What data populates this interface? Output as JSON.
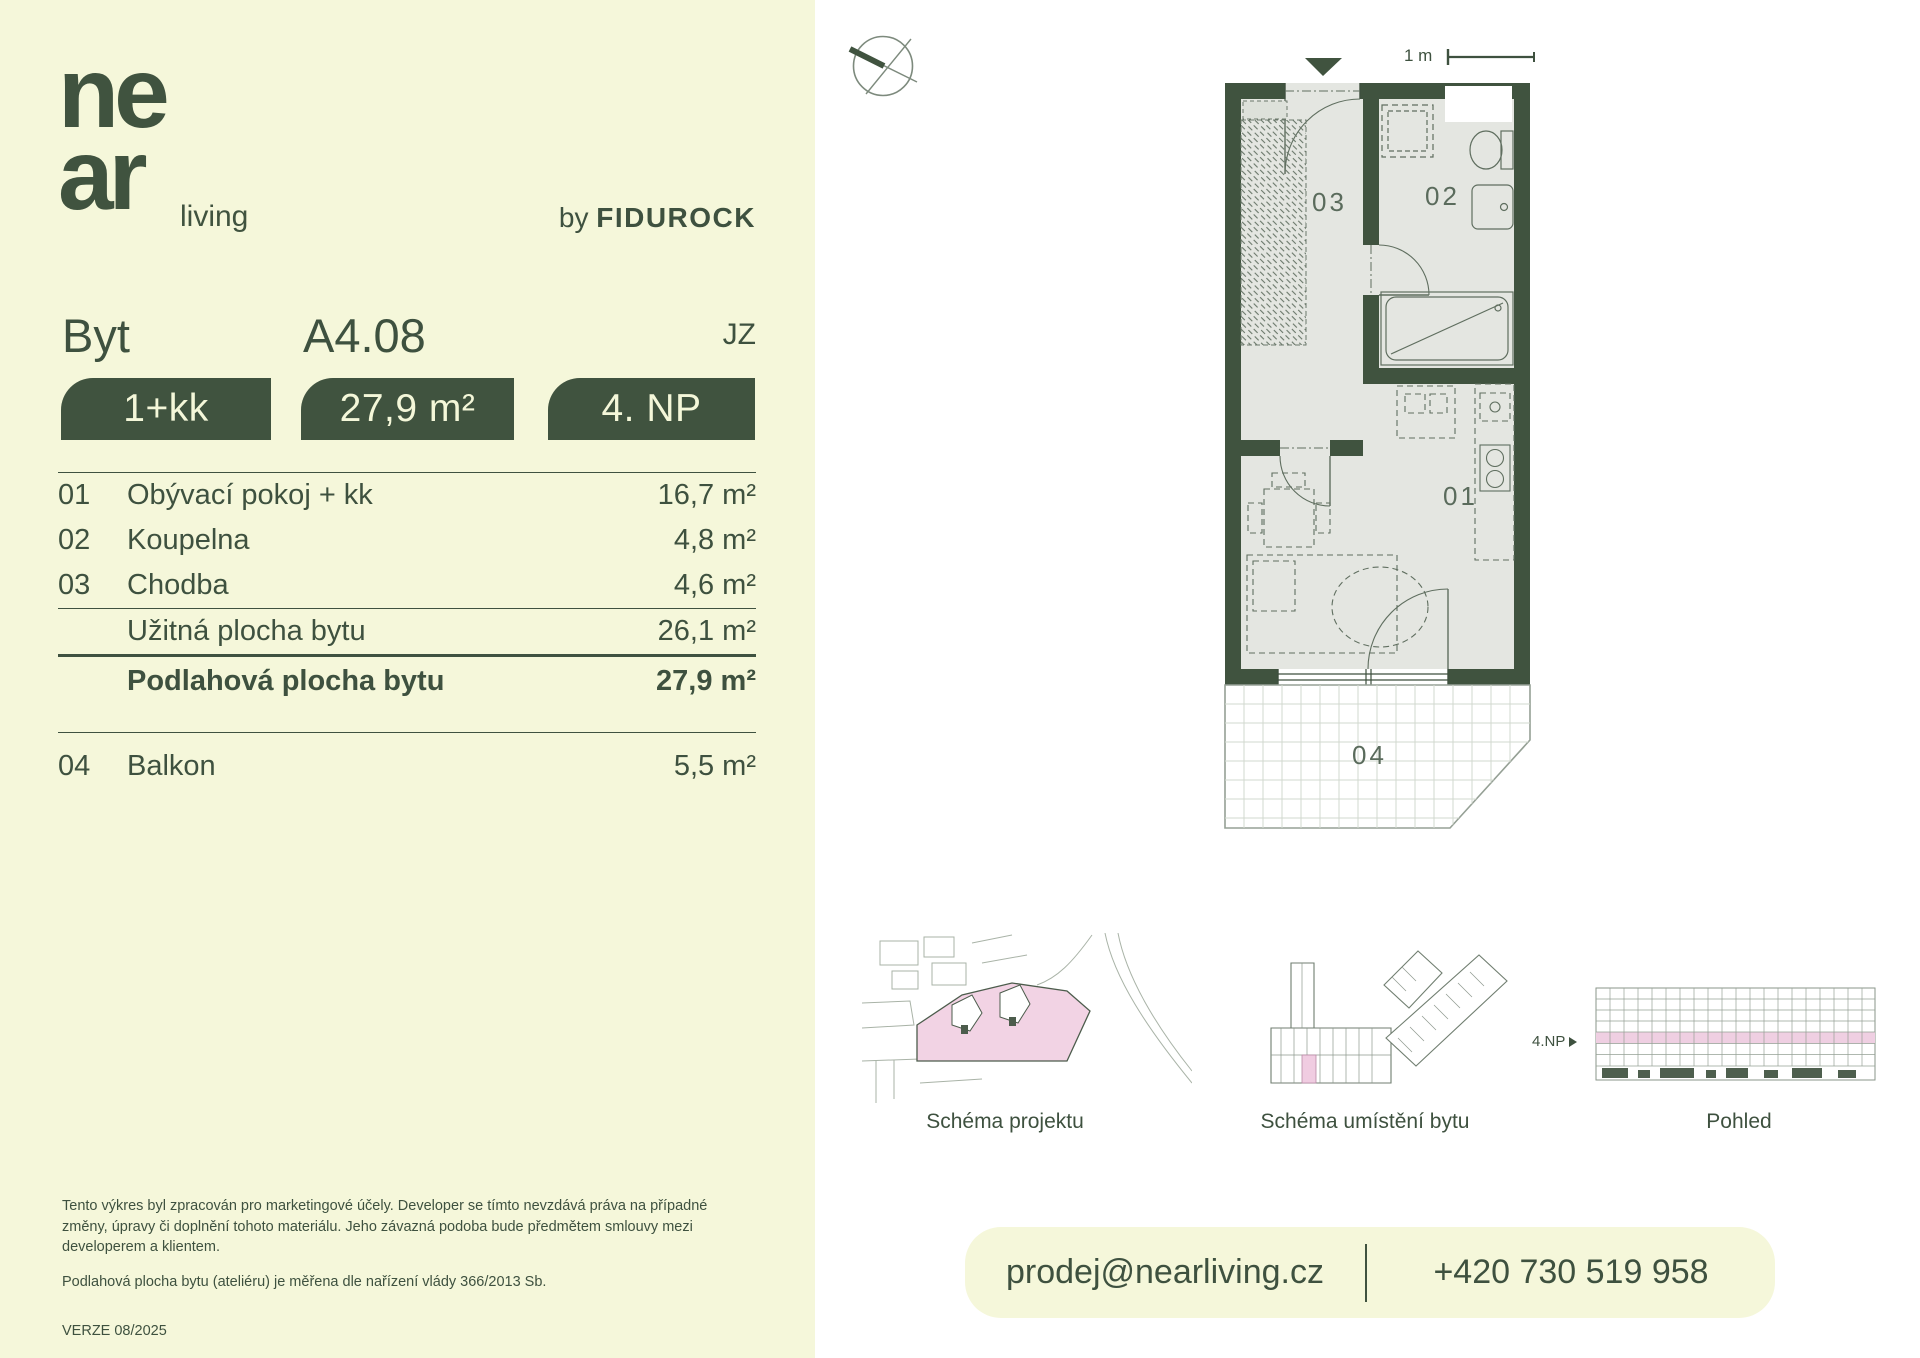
{
  "brand": {
    "logo_line1": "ne",
    "logo_line2": "ar",
    "logo_suffix": "living",
    "byline_prefix": "by",
    "byline_brand": "FIDUROCK"
  },
  "header": {
    "unit_label": "Byt",
    "unit_number": "A4.08",
    "orientation": "JZ"
  },
  "badges": [
    {
      "label": "1+kk"
    },
    {
      "label": "27,9 m²"
    },
    {
      "label": "4. NP"
    }
  ],
  "rooms": [
    {
      "num": "01",
      "name": "Obývací pokoj + kk",
      "area": "16,7 m²"
    },
    {
      "num": "02",
      "name": "Koupelna",
      "area": "4,8 m²"
    },
    {
      "num": "03",
      "name": "Chodba",
      "area": "4,6 m²"
    }
  ],
  "totals": {
    "usable_label": "Užitná plocha bytu",
    "usable_area": "26,1 m²",
    "floor_label": "Podlahová plocha bytu",
    "floor_area": "27,9 m²"
  },
  "extras": [
    {
      "num": "04",
      "name": "Balkon",
      "area": "5,5 m²"
    }
  ],
  "disclaimer": {
    "paragraph": "Tento výkres byl zpracován pro marketingové účely. Developer se tímto nevzdává práva na případné změny, úpravy či doplnění tohoto materiálu. Jeho závazná podoba bude předmětem smlouvy mezi developerem a klientem.",
    "note": "Podlahová plocha bytu (ateliéru) je měřena dle nařízení vlády 366/2013 Sb.",
    "version": "VERZE 08/2025"
  },
  "plan": {
    "scale_label": "1 m",
    "room_labels": [
      "01",
      "02",
      "03",
      "04"
    ]
  },
  "schematics": [
    {
      "caption": "Schéma projektu"
    },
    {
      "caption": "Schéma umístění bytu"
    },
    {
      "caption": "Pohled",
      "floor_marker": "4.NP"
    }
  ],
  "contact": {
    "email": "prodej@nearliving.cz",
    "phone": "+420 730 519 958"
  },
  "colors": {
    "cream": "#f5f7da",
    "green": "#40533f",
    "text": "#3e513f",
    "floor": "#e4e6e1",
    "pink": "#f2d3e4",
    "plan_label": "#5a6b5c"
  }
}
